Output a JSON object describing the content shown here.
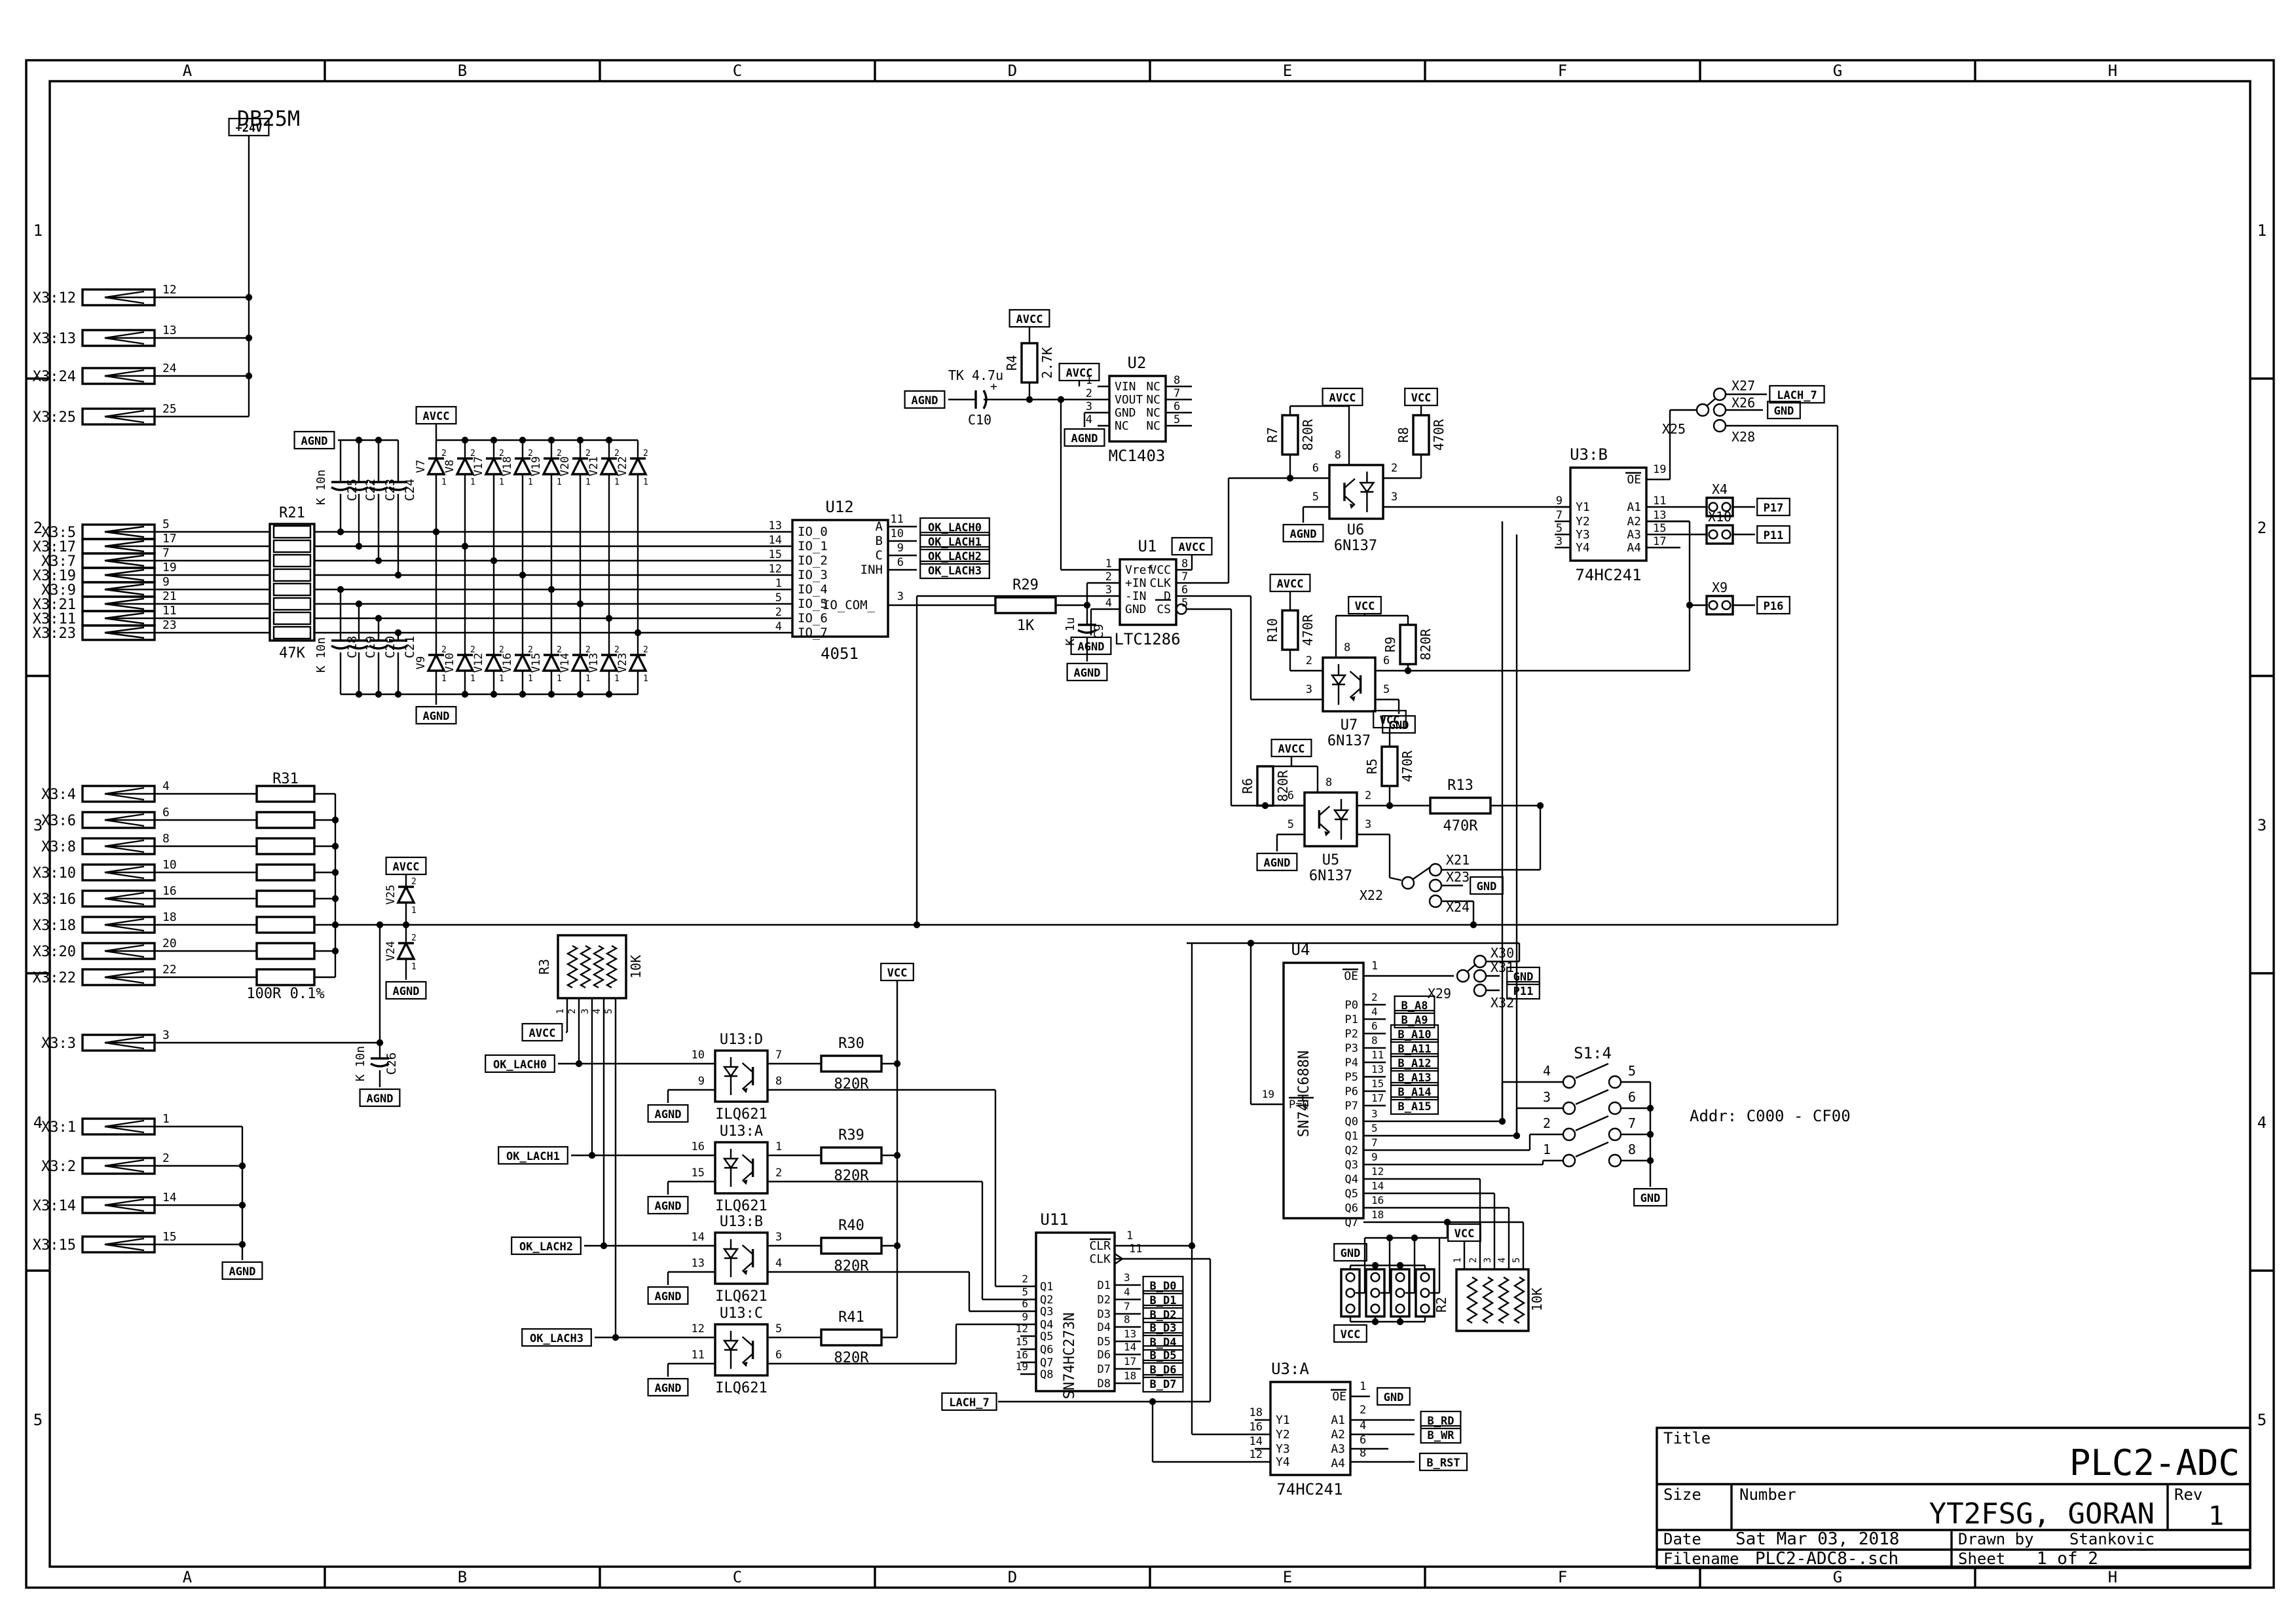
{
  "frame": {
    "cols": [
      "A",
      "B",
      "C",
      "D",
      "E",
      "F",
      "G",
      "H"
    ],
    "rows": [
      "1",
      "2",
      "3",
      "4",
      "5"
    ]
  },
  "title_block": {
    "title_label": "Title",
    "title": "PLC2-ADC",
    "size_label": "Size",
    "number_label": "Number",
    "number": "YT2FSG, GORAN",
    "rev_label": "Rev",
    "rev": "1",
    "date_label": "Date",
    "date": "Sat Mar 03, 2018",
    "drawn_label": "Drawn by",
    "drawn": "Stankovic",
    "filename_label": "Filename",
    "filename": "PLC2-ADC8-.sch",
    "sheet_label": "Sheet",
    "sheet": "1  of  2"
  },
  "notes": {
    "db25m": "DB25M",
    "addr": "Addr: C000 - CF00"
  },
  "flag_labels": {
    "p24": "+24V",
    "avcc": "AVCC",
    "agnd": "AGND",
    "vcc": "VCC",
    "gnd": "GND"
  },
  "net_labels": {
    "ok": [
      "OK_LACH0",
      "OK_LACH1",
      "OK_LACH2",
      "OK_LACH3"
    ],
    "lach7": "LACH_7",
    "p17": "P17",
    "p11": "P11",
    "p16": "P16",
    "bd": [
      "B_D0",
      "B_D1",
      "B_D2",
      "B_D3",
      "B_D4",
      "B_D5",
      "B_D6",
      "B_D7"
    ],
    "ba": [
      "B_A8",
      "B_A9",
      "B_A10",
      "B_A11",
      "B_A12",
      "B_A13",
      "B_A14",
      "B_A15"
    ],
    "brd": "B_RD",
    "bwr": "B_WR",
    "brst": "B_RST"
  },
  "connectors": {
    "top": [
      {
        "name": "X3:12",
        "pin": "12"
      },
      {
        "name": "X3:13",
        "pin": "13"
      },
      {
        "name": "X3:24",
        "pin": "24"
      },
      {
        "name": "X3:25",
        "pin": "25"
      }
    ],
    "analog": [
      {
        "name": "X3:5",
        "pin": "5"
      },
      {
        "name": "X3:17",
        "pin": "17"
      },
      {
        "name": "X3:7",
        "pin": "7"
      },
      {
        "name": "X3:19",
        "pin": "19"
      },
      {
        "name": "X3:9",
        "pin": "9"
      },
      {
        "name": "X3:21",
        "pin": "21"
      },
      {
        "name": "X3:11",
        "pin": "11"
      },
      {
        "name": "X3:23",
        "pin": "23"
      }
    ],
    "r31": [
      {
        "name": "X3:4",
        "pin": "4"
      },
      {
        "name": "X3:6",
        "pin": "6"
      },
      {
        "name": "X3:8",
        "pin": "8"
      },
      {
        "name": "X3:10",
        "pin": "10"
      },
      {
        "name": "X3:16",
        "pin": "16"
      },
      {
        "name": "X3:18",
        "pin": "18"
      },
      {
        "name": "X3:20",
        "pin": "20"
      },
      {
        "name": "X3:22",
        "pin": "22"
      }
    ],
    "x33": {
      "name": "X3:3",
      "pin": "3"
    },
    "gnd": [
      {
        "name": "X3:1",
        "pin": "1"
      },
      {
        "name": "X3:2",
        "pin": "2"
      },
      {
        "name": "X3:14",
        "pin": "14"
      },
      {
        "name": "X3:15",
        "pin": "15"
      }
    ]
  },
  "components": {
    "R21": {
      "ref": "R21",
      "value": "47K"
    },
    "R31": {
      "ref": "R31",
      "value": "100R 0.1%"
    },
    "R4": {
      "ref": "R4",
      "value": "2.7K"
    },
    "R29": {
      "ref": "R29",
      "value": "1K"
    },
    "R7": {
      "ref": "R7",
      "value": "820R"
    },
    "R8": {
      "ref": "R8",
      "value": "470R"
    },
    "R9": {
      "ref": "R9",
      "value": "820R"
    },
    "R10": {
      "ref": "R10",
      "value": "470R"
    },
    "R6": {
      "ref": "R6",
      "value": "820R"
    },
    "R5": {
      "ref": "R5",
      "value": "470R"
    },
    "R13": {
      "ref": "R13",
      "value": "470R"
    },
    "R3": {
      "ref": "R3",
      "value": "10K"
    },
    "R2": {
      "ref": "R2",
      "value": "10K"
    },
    "rnet_pins": [
      "1",
      "2",
      "3",
      "4",
      "5"
    ],
    "caps_top": [
      "C25",
      "C22",
      "C23",
      "C24"
    ],
    "caps_bot": [
      "C18",
      "C19",
      "C20",
      "C21"
    ],
    "cap_group_value": "K 10n",
    "C26": {
      "ref": "C26",
      "value": "K 10n"
    },
    "C9": {
      "ref": "C9",
      "value": "K 1u"
    },
    "C10": {
      "ref": "C10",
      "value": "TK 4.7u"
    },
    "diodes_top": [
      "V7",
      "V8",
      "V17",
      "V18",
      "V19",
      "V20",
      "V21",
      "V22"
    ],
    "diodes_bot": [
      "V9",
      "V10",
      "V12",
      "V16",
      "V15",
      "V14",
      "V13",
      "V23"
    ],
    "V25": "V25",
    "V24": "V24",
    "diode_pins": {
      "top": "2",
      "bottom": "1"
    }
  },
  "ics": {
    "U12": {
      "ref": "U12",
      "value": "4051",
      "left": [
        [
          "13",
          "IO_0"
        ],
        [
          "14",
          "IO_1"
        ],
        [
          "15",
          "IO_2"
        ],
        [
          "12",
          "IO_3"
        ],
        [
          "1",
          "IO_4"
        ],
        [
          "5",
          "IO_5"
        ],
        [
          "2",
          "IO_6"
        ],
        [
          "4",
          "IO_7"
        ]
      ],
      "right": [
        [
          "11",
          "A"
        ],
        [
          "10",
          "B"
        ],
        [
          "9",
          "C"
        ],
        [
          "6",
          "INH"
        ]
      ],
      "com": [
        "3",
        "IO_COM_"
      ]
    },
    "U2": {
      "ref": "U2",
      "value": "MC1403",
      "left": [
        [
          "1",
          "VIN"
        ],
        [
          "2",
          "VOUT"
        ],
        [
          "3",
          "GND"
        ],
        [
          "4",
          "NC"
        ]
      ],
      "right": [
        [
          "8",
          "NC"
        ],
        [
          "7",
          "NC"
        ],
        [
          "6",
          "NC"
        ],
        [
          "5",
          "NC"
        ]
      ]
    },
    "U1": {
      "ref": "U1",
      "value": "LTC1286",
      "left": [
        [
          "1",
          "Vref"
        ],
        [
          "2",
          "+IN"
        ],
        [
          "3",
          "-IN"
        ],
        [
          "4",
          "GND"
        ]
      ],
      "right": [
        [
          "8",
          "VCC"
        ],
        [
          "7",
          "CLK"
        ],
        [
          "6",
          "D"
        ],
        [
          "5",
          "CS"
        ]
      ]
    },
    "U6": {
      "ref": "U6",
      "value": "6N137"
    },
    "U7": {
      "ref": "U7",
      "value": "6N137"
    },
    "U5": {
      "ref": "U5",
      "value": "6N137"
    },
    "U3B": {
      "ref": "U3:B",
      "value": "74HC241",
      "left": [
        [
          "9",
          "Y1"
        ],
        [
          "7",
          "Y2"
        ],
        [
          "5",
          "Y3"
        ],
        [
          "3",
          "Y4"
        ]
      ],
      "oe": [
        "19",
        "OE"
      ],
      "right": [
        [
          "11",
          "A1"
        ],
        [
          "13",
          "A2"
        ],
        [
          "15",
          "A3"
        ],
        [
          "17",
          "A4"
        ]
      ]
    },
    "U3A": {
      "ref": "U3:A",
      "value": "74HC241",
      "left": [
        [
          "18",
          "Y1"
        ],
        [
          "16",
          "Y2"
        ],
        [
          "14",
          "Y3"
        ],
        [
          "12",
          "Y4"
        ]
      ],
      "oe": [
        "1",
        "OE"
      ],
      "right": [
        [
          "2",
          "A1"
        ],
        [
          "4",
          "A2"
        ],
        [
          "6",
          "A3"
        ],
        [
          "8",
          "A4"
        ]
      ]
    },
    "U11": {
      "ref": "U11",
      "value": "SN74HC273N",
      "left": [
        [
          "2",
          "Q1"
        ],
        [
          "5",
          "Q2"
        ],
        [
          "6",
          "Q3"
        ],
        [
          "9",
          "Q4"
        ],
        [
          "12",
          "Q5"
        ],
        [
          "15",
          "Q6"
        ],
        [
          "16",
          "Q7"
        ],
        [
          "19",
          "Q8"
        ]
      ],
      "clr": [
        "1",
        "CLR"
      ],
      "clk": [
        "11",
        "CLK"
      ],
      "right": [
        [
          "3",
          "D1"
        ],
        [
          "4",
          "D2"
        ],
        [
          "7",
          "D3"
        ],
        [
          "8",
          "D4"
        ],
        [
          "13",
          "D5"
        ],
        [
          "14",
          "D6"
        ],
        [
          "17",
          "D7"
        ],
        [
          "18",
          "D8"
        ]
      ]
    },
    "U4": {
      "ref": "U4",
      "value": "SN74HC688N",
      "oe": [
        "1",
        "OE"
      ],
      "peq": [
        "19",
        "P=Q"
      ],
      "p": [
        [
          "2",
          "P0"
        ],
        [
          "4",
          "P1"
        ],
        [
          "6",
          "P2"
        ],
        [
          "8",
          "P3"
        ],
        [
          "11",
          "P4"
        ],
        [
          "13",
          "P5"
        ],
        [
          "15",
          "P6"
        ],
        [
          "17",
          "P7"
        ]
      ],
      "q": [
        [
          "3",
          "Q0"
        ],
        [
          "5",
          "Q1"
        ],
        [
          "7",
          "Q2"
        ],
        [
          "9",
          "Q3"
        ],
        [
          "12",
          "Q4"
        ],
        [
          "14",
          "Q5"
        ],
        [
          "16",
          "Q6"
        ],
        [
          "18",
          "Q7"
        ]
      ]
    },
    "U13": {
      "value": "ILQ621",
      "parts": [
        {
          "ref": "U13:D",
          "lp": [
            "10",
            "9"
          ],
          "rp": [
            "7",
            "8"
          ],
          "res": "R30",
          "rval": "820R"
        },
        {
          "ref": "U13:A",
          "lp": [
            "16",
            "15"
          ],
          "rp": [
            "1",
            "2"
          ],
          "res": "R39",
          "rval": "820R"
        },
        {
          "ref": "U13:B",
          "lp": [
            "14",
            "13"
          ],
          "rp": [
            "3",
            "4"
          ],
          "res": "R40",
          "rval": "820R"
        },
        {
          "ref": "U13:C",
          "lp": [
            "12",
            "11"
          ],
          "rp": [
            "5",
            "6"
          ],
          "res": "R41",
          "rval": "820R"
        }
      ]
    }
  },
  "jumpers": {
    "x25": {
      "common": "X25",
      "opts": [
        "X27",
        "X26",
        "X28"
      ]
    },
    "x22": {
      "common": "X22",
      "opts": [
        "X21",
        "X23",
        "X24"
      ]
    },
    "x29": {
      "common": "X29",
      "opts": [
        "X30",
        "X31",
        "X32"
      ]
    },
    "x4": "X4",
    "x10": "X10",
    "x9": "X9"
  },
  "switch": {
    "ref": "S1:4",
    "left": [
      "4",
      "3",
      "2",
      "1"
    ],
    "right": [
      "5",
      "6",
      "7",
      "8"
    ]
  }
}
